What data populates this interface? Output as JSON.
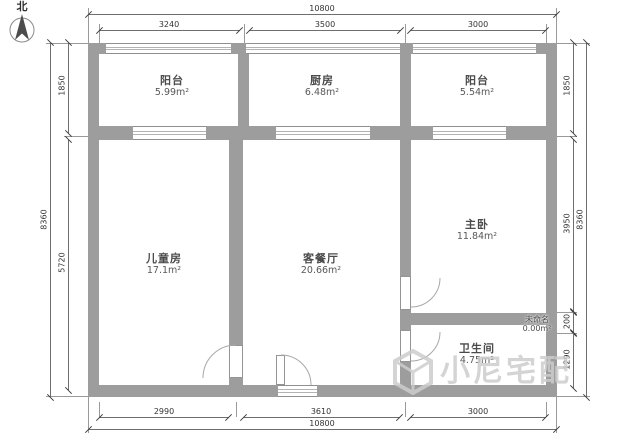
{
  "title": "户型图 / floor plan",
  "compass": {
    "north_label": "北"
  },
  "rooms": {
    "balcony_left": {
      "name": "阳台",
      "area": "5.99m²"
    },
    "kitchen": {
      "name": "厨房",
      "area": "6.48m²"
    },
    "balcony_right": {
      "name": "阳台",
      "area": "5.54m²"
    },
    "kids_room": {
      "name": "儿童房",
      "area": "17.1m²"
    },
    "living_dining": {
      "name": "客餐厅",
      "area": "20.66m²"
    },
    "master_bedroom": {
      "name": "主卧",
      "area": "11.84m²"
    },
    "bathroom": {
      "name": "卫生间",
      "area": "4.75m²"
    },
    "unnamed": {
      "name": "未命名",
      "area": "0.00m²"
    }
  },
  "dimensions": {
    "top": {
      "overall": "10800",
      "segments": [
        "3240",
        "3500",
        "3000"
      ]
    },
    "bottom": {
      "overall": "10800",
      "segments": [
        "2990",
        "3610",
        "3000"
      ]
    },
    "left": {
      "overall": "8360",
      "segments": [
        "1850",
        "5720"
      ]
    },
    "right": {
      "overall": "8360",
      "segments": [
        "1850",
        "3950",
        "200",
        "1290"
      ]
    }
  },
  "watermark": {
    "text": "小尼宅配"
  },
  "colors": {
    "wall": "#9d9d9d",
    "dimension_line": "#6e6e6e",
    "watermark": "#cdcdcd"
  }
}
